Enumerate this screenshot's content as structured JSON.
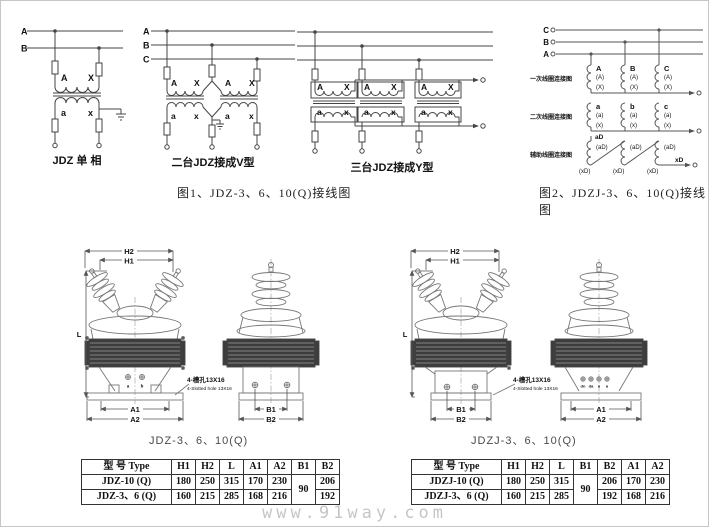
{
  "watermark": "www.91way.com",
  "fig1": {
    "caption": "图1、JDZ-3、6、10(Q)接线图",
    "single": {
      "title": "JDZ 单  相",
      "bus": {
        "a": "A",
        "b": "B"
      },
      "prim": {
        "a": "A",
        "x": "X"
      },
      "sec": {
        "a": "a",
        "x": "x"
      }
    },
    "v": {
      "title": "二台JDZ接成V型",
      "bus": {
        "a": "A",
        "b": "B",
        "c": "C"
      },
      "labels": {
        "p1a": "A",
        "p1x": "X",
        "p2a": "A",
        "p2x": "X",
        "s1a": "a",
        "s1x": "x",
        "s2a": "a",
        "s2x": "x"
      }
    },
    "y": {
      "title": "三台JDZ接成Y型",
      "labels": {
        "pa": "A",
        "px": "X",
        "sa": "a",
        "sx": "x"
      }
    }
  },
  "fig2": {
    "caption": "图2、JDZJ-3、6、10(Q)接线图",
    "bus": {
      "c": "C",
      "b": "B",
      "a": "A"
    },
    "row1": {
      "label": "一次线圈连接图",
      "t1": "A",
      "t2": "B",
      "t3": "C",
      "mid": "(A)",
      "bot": "(X)"
    },
    "row2": {
      "label": "二次线圈连接图",
      "t1": "a",
      "t2": "b",
      "t3": "c",
      "mid": "(a)",
      "bot": "(x)"
    },
    "row3": {
      "label": "辅助线圈连接图",
      "top": "aD",
      "mid": "(aD)",
      "bot": "(xD)",
      "out": "xD"
    }
  },
  "outline_jdz": {
    "caption": "JDZ-3、6、10(Q)",
    "dims": {
      "h1": "H1",
      "h2": "H2",
      "l": "L",
      "a1": "A1",
      "a2": "A2",
      "b1": "B1",
      "b2": "B2"
    },
    "terminals": {
      "t1": "a",
      "t2": "b"
    },
    "slot_cn": "4-槽孔13X16",
    "slot_en": "4-Slotted hole 13X16"
  },
  "outline_jdzj": {
    "caption": "JDZJ-3、6、10(Q)",
    "dims": {
      "h1": "H1",
      "h2": "H2",
      "l": "L",
      "a1": "A1",
      "a2": "A2",
      "b1": "B1",
      "b2": "B2"
    },
    "terminals": {
      "t1": "dn",
      "t2": "da",
      "t3": "n",
      "t4": "a"
    },
    "slot_cn": "4-槽孔13X16",
    "slot_en": "4-Slotted hole 13X16"
  },
  "table_jdz": {
    "headers": [
      "型  号 Type",
      "H1",
      "H2",
      "L",
      "A1",
      "A2",
      "B1",
      "B2"
    ],
    "rows": [
      [
        "JDZ-10 (Q)",
        "180",
        "250",
        "315",
        "170",
        "230",
        "90",
        "206"
      ],
      [
        "JDZ-3、6 (Q)",
        "160",
        "215",
        "285",
        "168",
        "216",
        "192"
      ]
    ]
  },
  "table_jdzj": {
    "headers": [
      "型  号 Type",
      "H1",
      "H2",
      "L",
      "B1",
      "B2",
      "A1",
      "A2"
    ],
    "rows": [
      [
        "JDZJ-10 (Q)",
        "180",
        "250",
        "315",
        "90",
        "206",
        "170",
        "230"
      ],
      [
        "JDZJ-3、6 (Q)",
        "160",
        "215",
        "285",
        "192",
        "168",
        "216"
      ]
    ]
  }
}
